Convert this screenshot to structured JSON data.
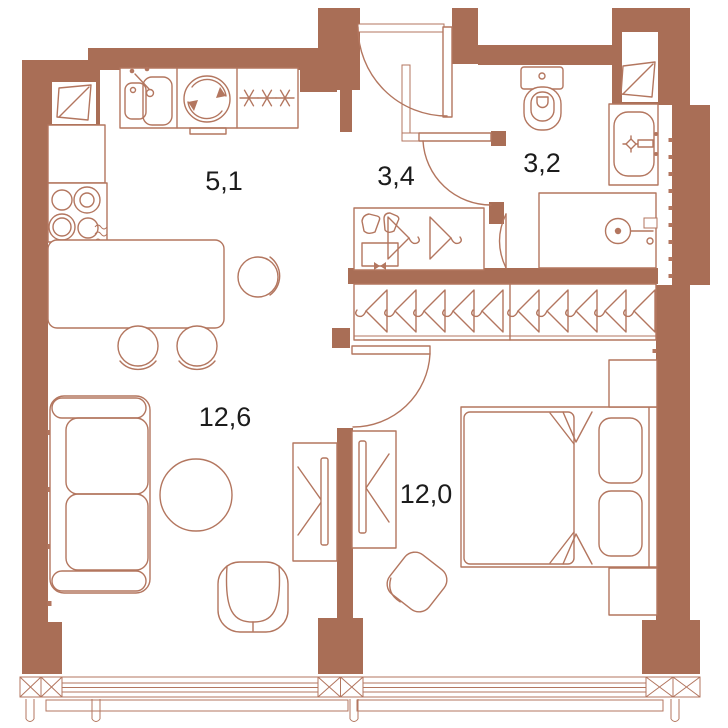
{
  "plan": {
    "type": "apartment-floor-plan",
    "rooms": {
      "kitchen_living": {
        "name": "kitchen",
        "area": "5,1"
      },
      "hallway": {
        "name": "hallway",
        "area": "3,4"
      },
      "bathroom": {
        "name": "bathroom",
        "area": "3,2"
      },
      "living_room": {
        "name": "living room",
        "area": "12,6"
      },
      "bedroom": {
        "name": "bedroom",
        "area": "12,0"
      }
    },
    "colors": {
      "wall": "#a96e56",
      "line": "#b3765f",
      "label": "#1c1c1c",
      "background": "#ffffff"
    },
    "fixtures": [
      "kitchen-sink",
      "washing-machine",
      "fridge-freezer",
      "cooktop",
      "kitchen-cabinet",
      "kitchen-island",
      "bar-stool",
      "bar-stool",
      "bar-stool",
      "sofa",
      "coffee-table",
      "armchair",
      "tv-unit-living",
      "tv-unit-bedroom",
      "hall-wardrobe",
      "closet-hanger-rail",
      "toilet",
      "washbasin",
      "shower",
      "bed",
      "pillow",
      "pillow",
      "nightstand",
      "nightstand",
      "pouf",
      "entry-door",
      "bathroom-door",
      "shower-room-door",
      "living-room-door",
      "vent-window",
      "vent-window",
      "panoramic-window",
      "panoramic-window"
    ]
  }
}
